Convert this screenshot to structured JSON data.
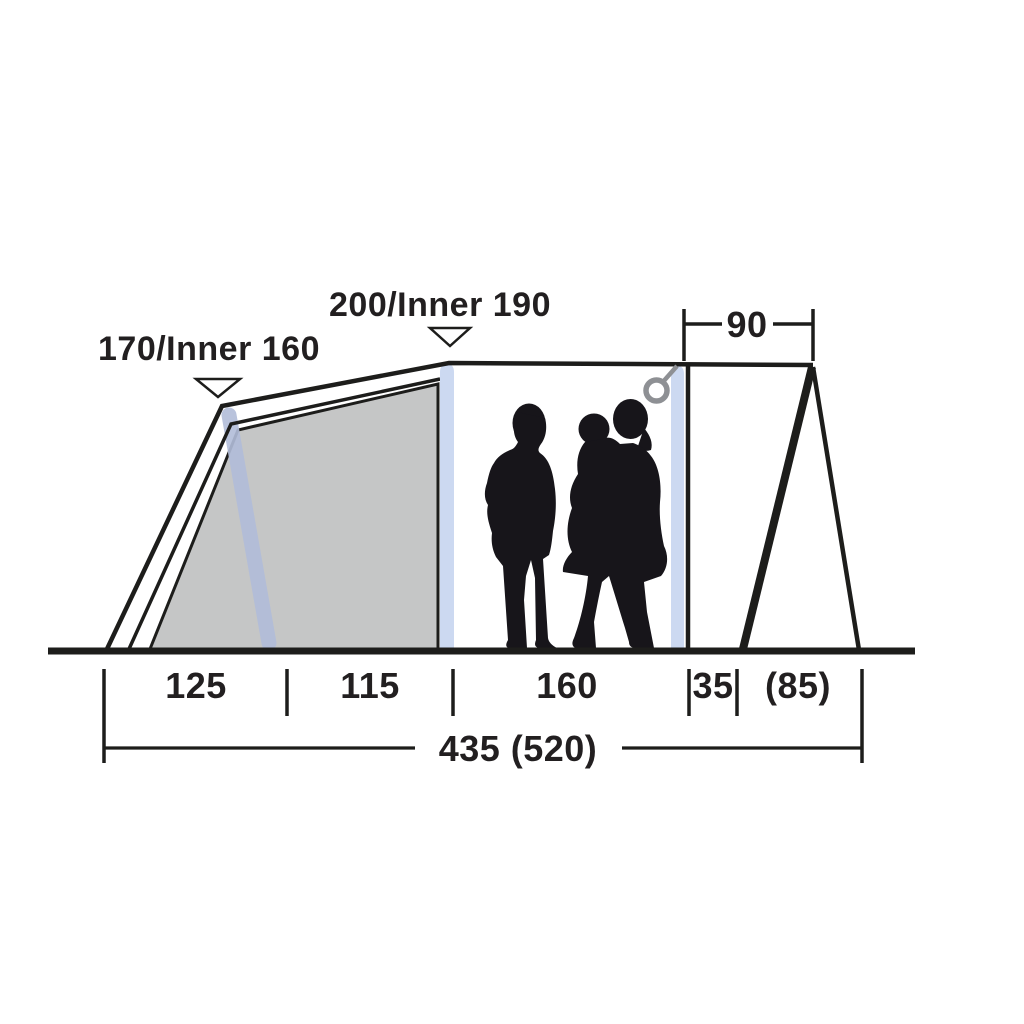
{
  "diagram": {
    "kind": "tent-side-view-dimension-drawing",
    "figures_alt": "family silhouette: two adults, one child"
  },
  "dimensions": {
    "peak_heights": [
      {
        "label": "170/Inner 160"
      },
      {
        "label": "200/Inner 190"
      }
    ],
    "guy_span": {
      "label": "90"
    },
    "floor_segments": [
      {
        "label": "125"
      },
      {
        "label": "115"
      },
      {
        "label": "160"
      },
      {
        "label": "35"
      },
      {
        "label": "(85)"
      }
    ],
    "total_length": {
      "label": "435 (520)"
    }
  },
  "colors": {
    "line": "#1d1d1b",
    "text": "#221f20",
    "inner_tent": "#c5c6c6",
    "pole": "#ccd9f1",
    "pole_shaded": "#b2bdd9",
    "ring": "#8e9094",
    "silhouette": "#17151a",
    "background": "#ffffff"
  }
}
